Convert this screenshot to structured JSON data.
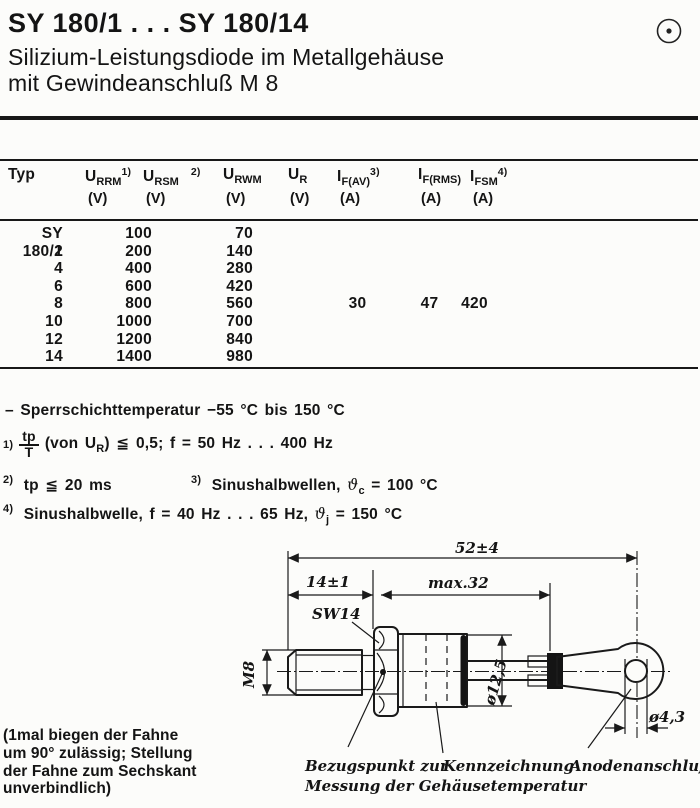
{
  "page": {
    "title": "SY 180/1 . . . SY 180/14",
    "subtitle_line1": "Silizium-Leistungsdiode im Metallgehäuse",
    "subtitle_line2": "mit Gewindeanschluß M 8",
    "corner_icon": "circle-dot-mark"
  },
  "table": {
    "headers": [
      {
        "main": "Typ",
        "sub": "",
        "sup": "",
        "unit": ""
      },
      {
        "main": "U",
        "sub": "RRM",
        "sup": "1)",
        "unit": "(V)"
      },
      {
        "main": "U",
        "sub": "RSM",
        "sup": "2)",
        "unit": "(V)"
      },
      {
        "main": "U",
        "sub": "RWM",
        "sup": "",
        "unit": "(V)"
      },
      {
        "main": "U",
        "sub": "R",
        "sup": "",
        "unit": "(V)"
      },
      {
        "main": "I",
        "sub": "F(AV)",
        "sup": "3)",
        "unit": "(A)"
      },
      {
        "main": "I",
        "sub": "F(RMS)",
        "sup": "",
        "unit": "(A)"
      },
      {
        "main": "I",
        "sub": "FSM",
        "sup": "4)",
        "unit": "(A)"
      }
    ],
    "rows": [
      {
        "typ": "SY 180/1",
        "u_rrm": "100",
        "u_rwm": "70",
        "i_fav": "",
        "i_frms": "",
        "i_fsm": ""
      },
      {
        "typ": "2",
        "u_rrm": "200",
        "u_rwm": "140",
        "i_fav": "",
        "i_frms": "",
        "i_fsm": ""
      },
      {
        "typ": "4",
        "u_rrm": "400",
        "u_rwm": "280",
        "i_fav": "",
        "i_frms": "",
        "i_fsm": ""
      },
      {
        "typ": "6",
        "u_rrm": "600",
        "u_rwm": "420",
        "i_fav": "",
        "i_frms": "",
        "i_fsm": ""
      },
      {
        "typ": "8",
        "u_rrm": "800",
        "u_rwm": "560",
        "i_fav": "30",
        "i_frms": "47",
        "i_fsm": "420"
      },
      {
        "typ": "10",
        "u_rrm": "1000",
        "u_rwm": "700",
        "i_fav": "",
        "i_frms": "",
        "i_fsm": ""
      },
      {
        "typ": "12",
        "u_rrm": "1200",
        "u_rwm": "840",
        "i_fav": "",
        "i_frms": "",
        "i_fsm": ""
      },
      {
        "typ": "14",
        "u_rrm": "1400",
        "u_rwm": "980",
        "i_fav": "",
        "i_frms": "",
        "i_fsm": ""
      }
    ]
  },
  "notes": {
    "temp": "– Sperrschichttemperatur −55 °C bis 150 °C",
    "n1_ref": "1)",
    "n1_num": "tp",
    "n1_den": "T",
    "n1_pre": "(von U",
    "n1_sub": "R",
    "n1_rest": ") ≦ 0,5;  f = 50 Hz . . . 400 Hz",
    "n2_ref": "2)",
    "n2_text": "tp ≦ 20 ms",
    "n3_ref": "3)",
    "n3_pre": "Sinushalbwellen,",
    "n3_sym": "ϑ",
    "n3_sub": "c",
    "n3_post": "= 100 °C",
    "n4_ref": "4)",
    "n4_pre": "Sinushalbwelle, f = 40 Hz . . . 65 Hz,",
    "n4_sym": "ϑ",
    "n4_sub": "j",
    "n4_post": "= 150 °C"
  },
  "drawing": {
    "dim_total": "52±4",
    "dim_stud": "14±1",
    "dim_case": "max.32",
    "wrench_size": "SW14",
    "thread": "M8",
    "dia_case": "ø12,5",
    "dia_hole": "ø4,3",
    "label_ref_point_1": "Bezugspunkt zur",
    "label_ref_point_2": "Messung der Gehäusetemperatur",
    "label_marking": "Kennzeichnung",
    "label_anode": "Anodenanschluß"
  },
  "bottom_note": {
    "line1": "(1mal biegen der Fahne",
    "line2": "um 90° zulässig; Stellung",
    "line3": "der Fahne zum Sechskant",
    "line4": "unverbindlich)"
  }
}
